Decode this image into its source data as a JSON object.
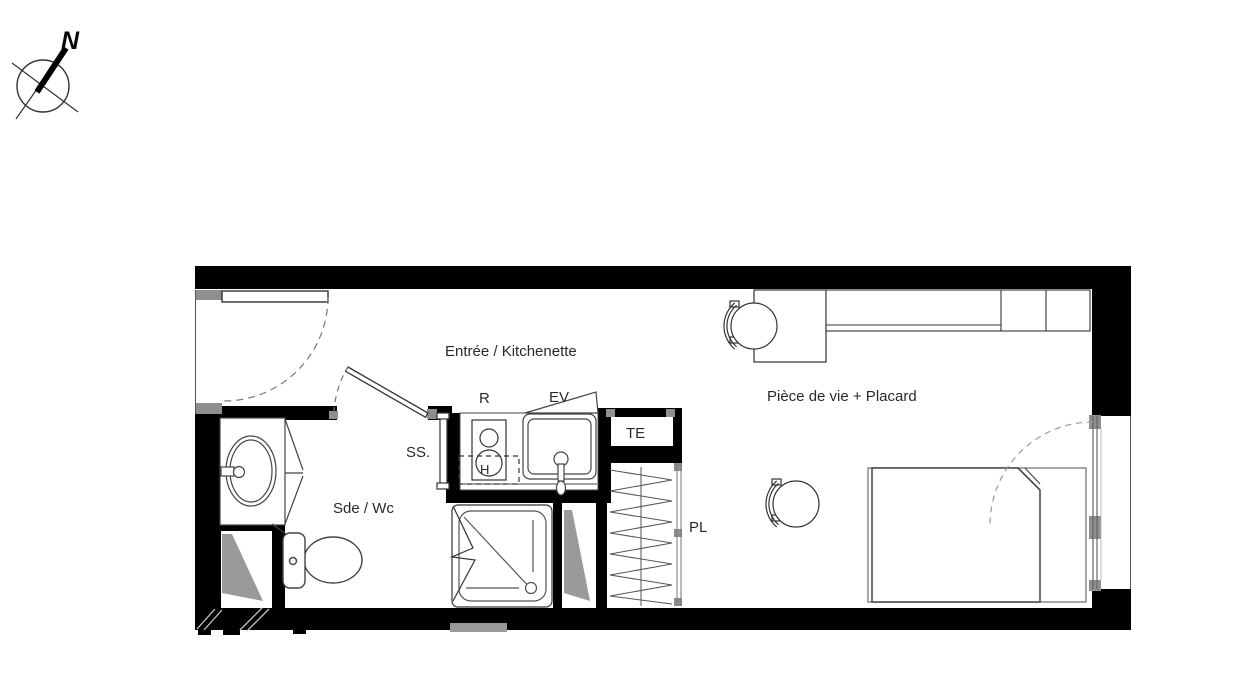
{
  "compass": {
    "north": "N"
  },
  "rooms": {
    "entree": {
      "label": "Entrée / Kitchenette"
    },
    "piece_de_vie": {
      "label": "Pièce de vie + Placard"
    },
    "sde_wc": {
      "label": "Sde / Wc"
    }
  },
  "fixtures": {
    "refrigerateur": {
      "label": "R"
    },
    "evier": {
      "label": "EV"
    },
    "tableau_electrique": {
      "label": "TE"
    },
    "seche_serviettes": {
      "label": "SS."
    },
    "placard": {
      "label": "PL"
    },
    "hotte": {
      "label": "H"
    }
  },
  "colors": {
    "background": "#ffffff",
    "wall": "#000000",
    "jamb_gray": "#8f8f8f",
    "shaft_gray": "#9a9a9a",
    "line_dark": "#333333",
    "line_light": "#888888",
    "text": "#242a30"
  }
}
